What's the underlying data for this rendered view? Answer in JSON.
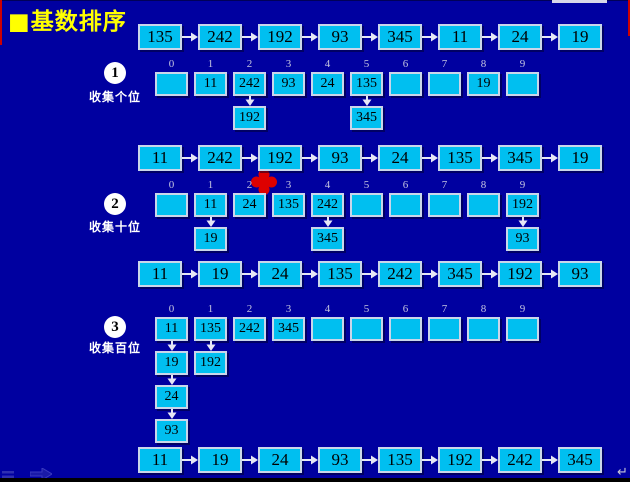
{
  "title": "■基数排序",
  "lists": [
    {
      "name": "initial-list",
      "values": [
        "135",
        "242",
        "192",
        "93",
        "345",
        "11",
        "24",
        "19"
      ]
    },
    {
      "name": "after-pass-1-list",
      "values": [
        "11",
        "242",
        "192",
        "93",
        "24",
        "135",
        "345",
        "19"
      ]
    },
    {
      "name": "after-pass-2-list",
      "values": [
        "11",
        "19",
        "24",
        "135",
        "242",
        "345",
        "192",
        "93"
      ]
    },
    {
      "name": "final-list",
      "values": [
        "11",
        "19",
        "24",
        "93",
        "135",
        "192",
        "242",
        "345"
      ]
    }
  ],
  "bucket_indices": [
    "0",
    "1",
    "2",
    "3",
    "4",
    "5",
    "6",
    "7",
    "8",
    "9"
  ],
  "passes": [
    {
      "badge": "1",
      "label": "收集个位",
      "buckets": [
        [],
        [
          "11"
        ],
        [
          "242",
          "192"
        ],
        [
          "93"
        ],
        [
          "24"
        ],
        [
          "135",
          "345"
        ],
        [],
        [],
        [
          "19"
        ],
        []
      ]
    },
    {
      "badge": "2",
      "label": "收集十位",
      "buckets": [
        [],
        [
          "11",
          "19"
        ],
        [
          "24"
        ],
        [
          "135"
        ],
        [
          "242",
          "345"
        ],
        [],
        [],
        [],
        [],
        [
          "192",
          "93"
        ]
      ]
    },
    {
      "badge": "3",
      "label": "收集百位",
      "buckets": [
        [
          "11",
          "19",
          "24",
          "93"
        ],
        [
          "135",
          "192"
        ],
        [
          "242"
        ],
        [
          "345"
        ],
        [],
        [],
        [],
        [],
        [],
        []
      ]
    }
  ],
  "footer": {
    "return_symbol": "↵"
  },
  "colors": {
    "background": "#0000A0",
    "box_fill": "#00BFF0",
    "box_border": "#C9D6EA",
    "title": "#FFFF00",
    "label_text": "#FFFFFF",
    "marker_red": "#DE0000",
    "arrow": "#E6E6F5"
  }
}
